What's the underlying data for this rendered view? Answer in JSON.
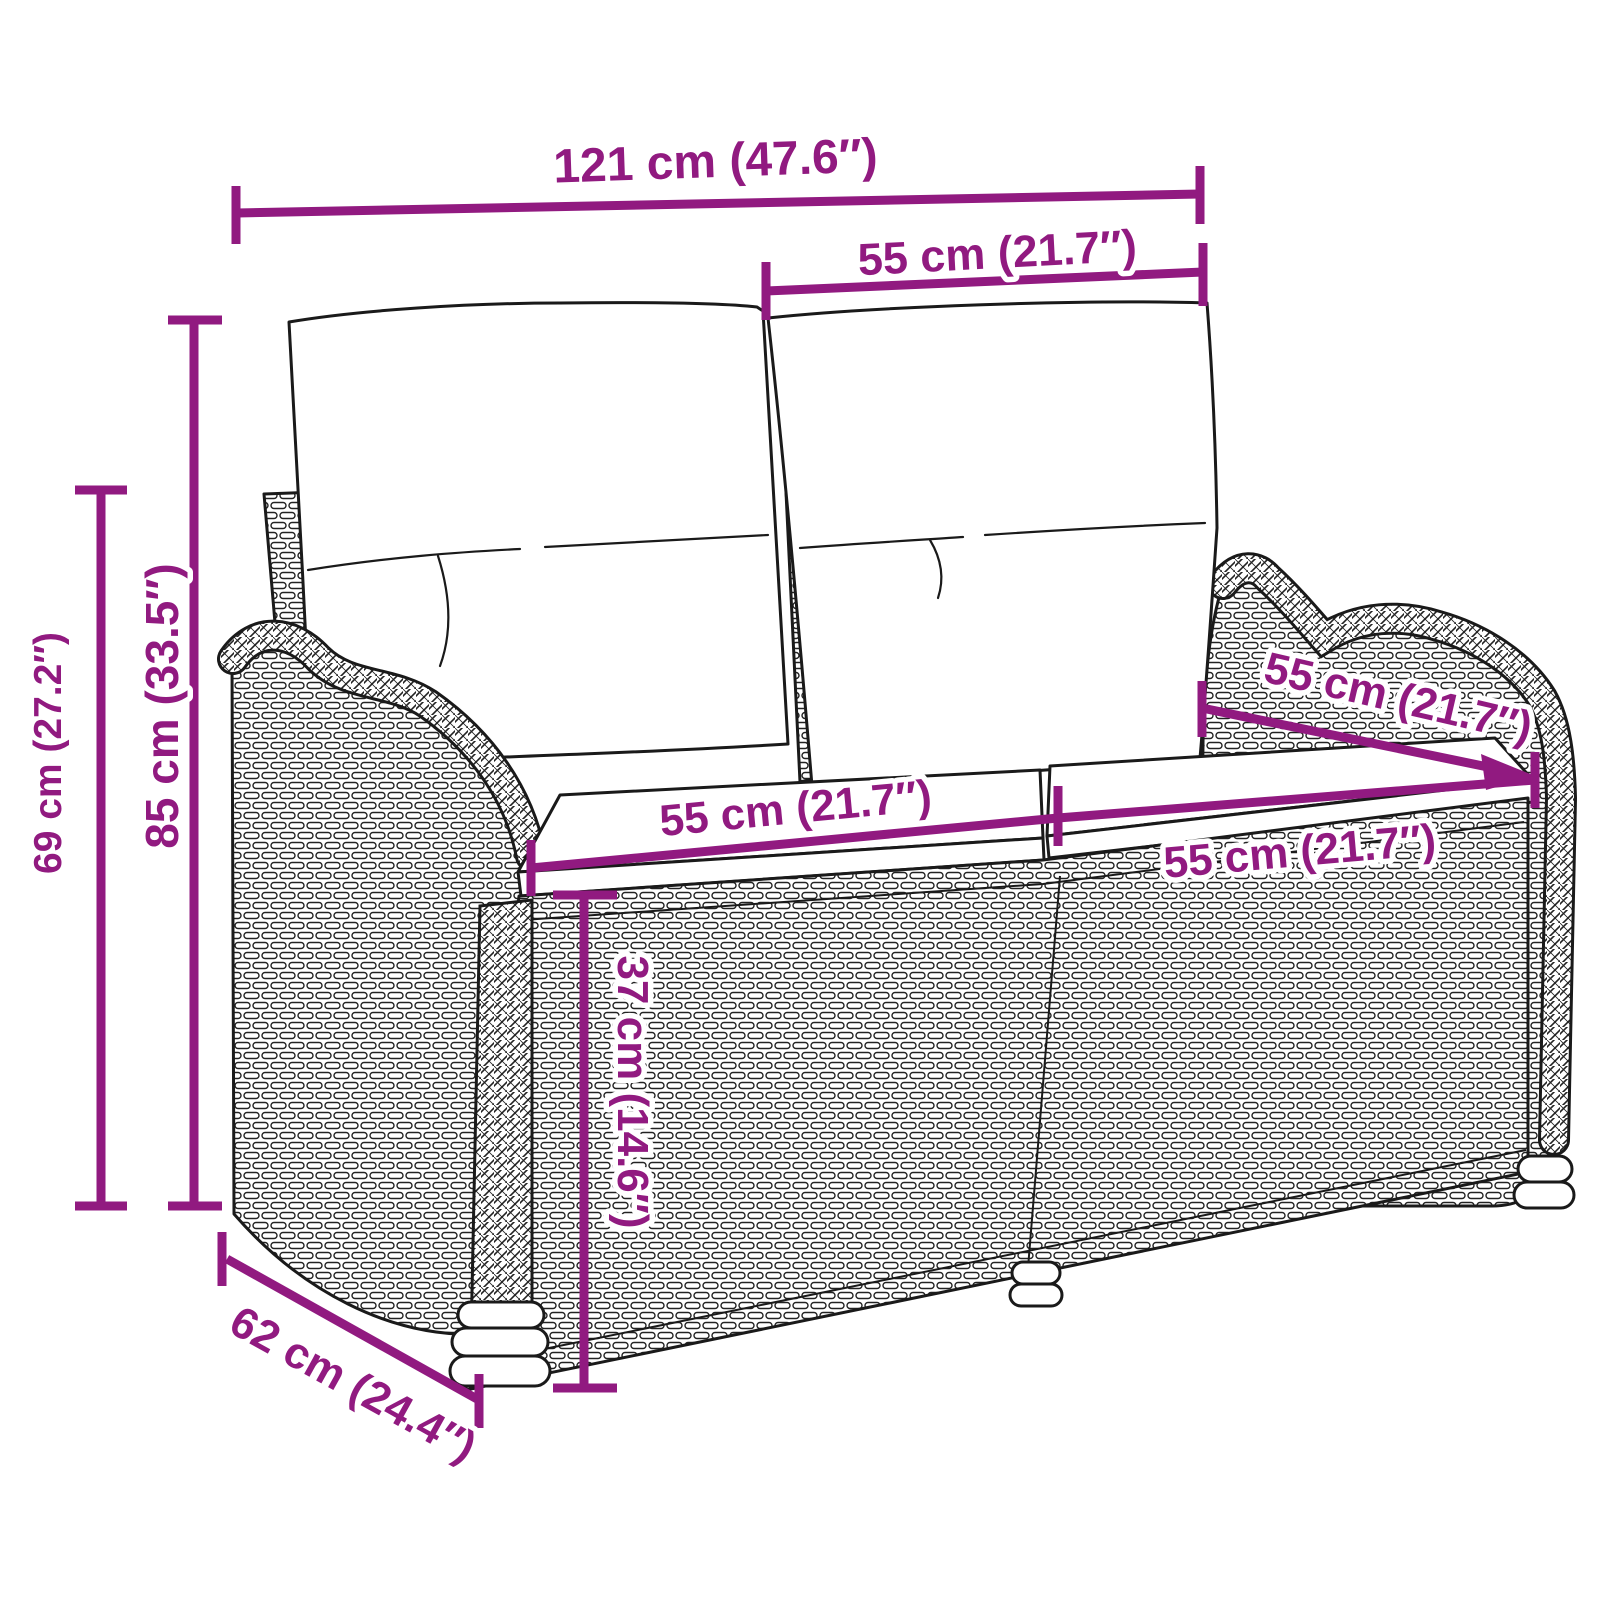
{
  "figure": {
    "kind": "product dimension diagram",
    "subject_visible_as": "line drawing of a 2-seater rattan garden bench with back and seat cushions"
  },
  "colors": {
    "dimension_annotation": "#911A80",
    "line_art": "#1A1A1A",
    "background": "#FFFFFF"
  },
  "dimensions": {
    "overall_width": {
      "label": "121 cm (47.6″)"
    },
    "backrest_width": {
      "label": "55 cm (21.7″)"
    },
    "overall_height": {
      "label": "85 cm (33.5″)"
    },
    "armrest_height": {
      "label": "69 cm (27.2″)"
    },
    "seat_width_left": {
      "label": "55 cm (21.7″)"
    },
    "seat_width_right": {
      "label": "55 cm (21.7″)"
    },
    "seat_depth": {
      "label": "55 cm (21.7″)"
    },
    "seat_height": {
      "label": "37 cm (14.6″)"
    },
    "overall_depth": {
      "label": "62 cm (24.4″)"
    }
  }
}
